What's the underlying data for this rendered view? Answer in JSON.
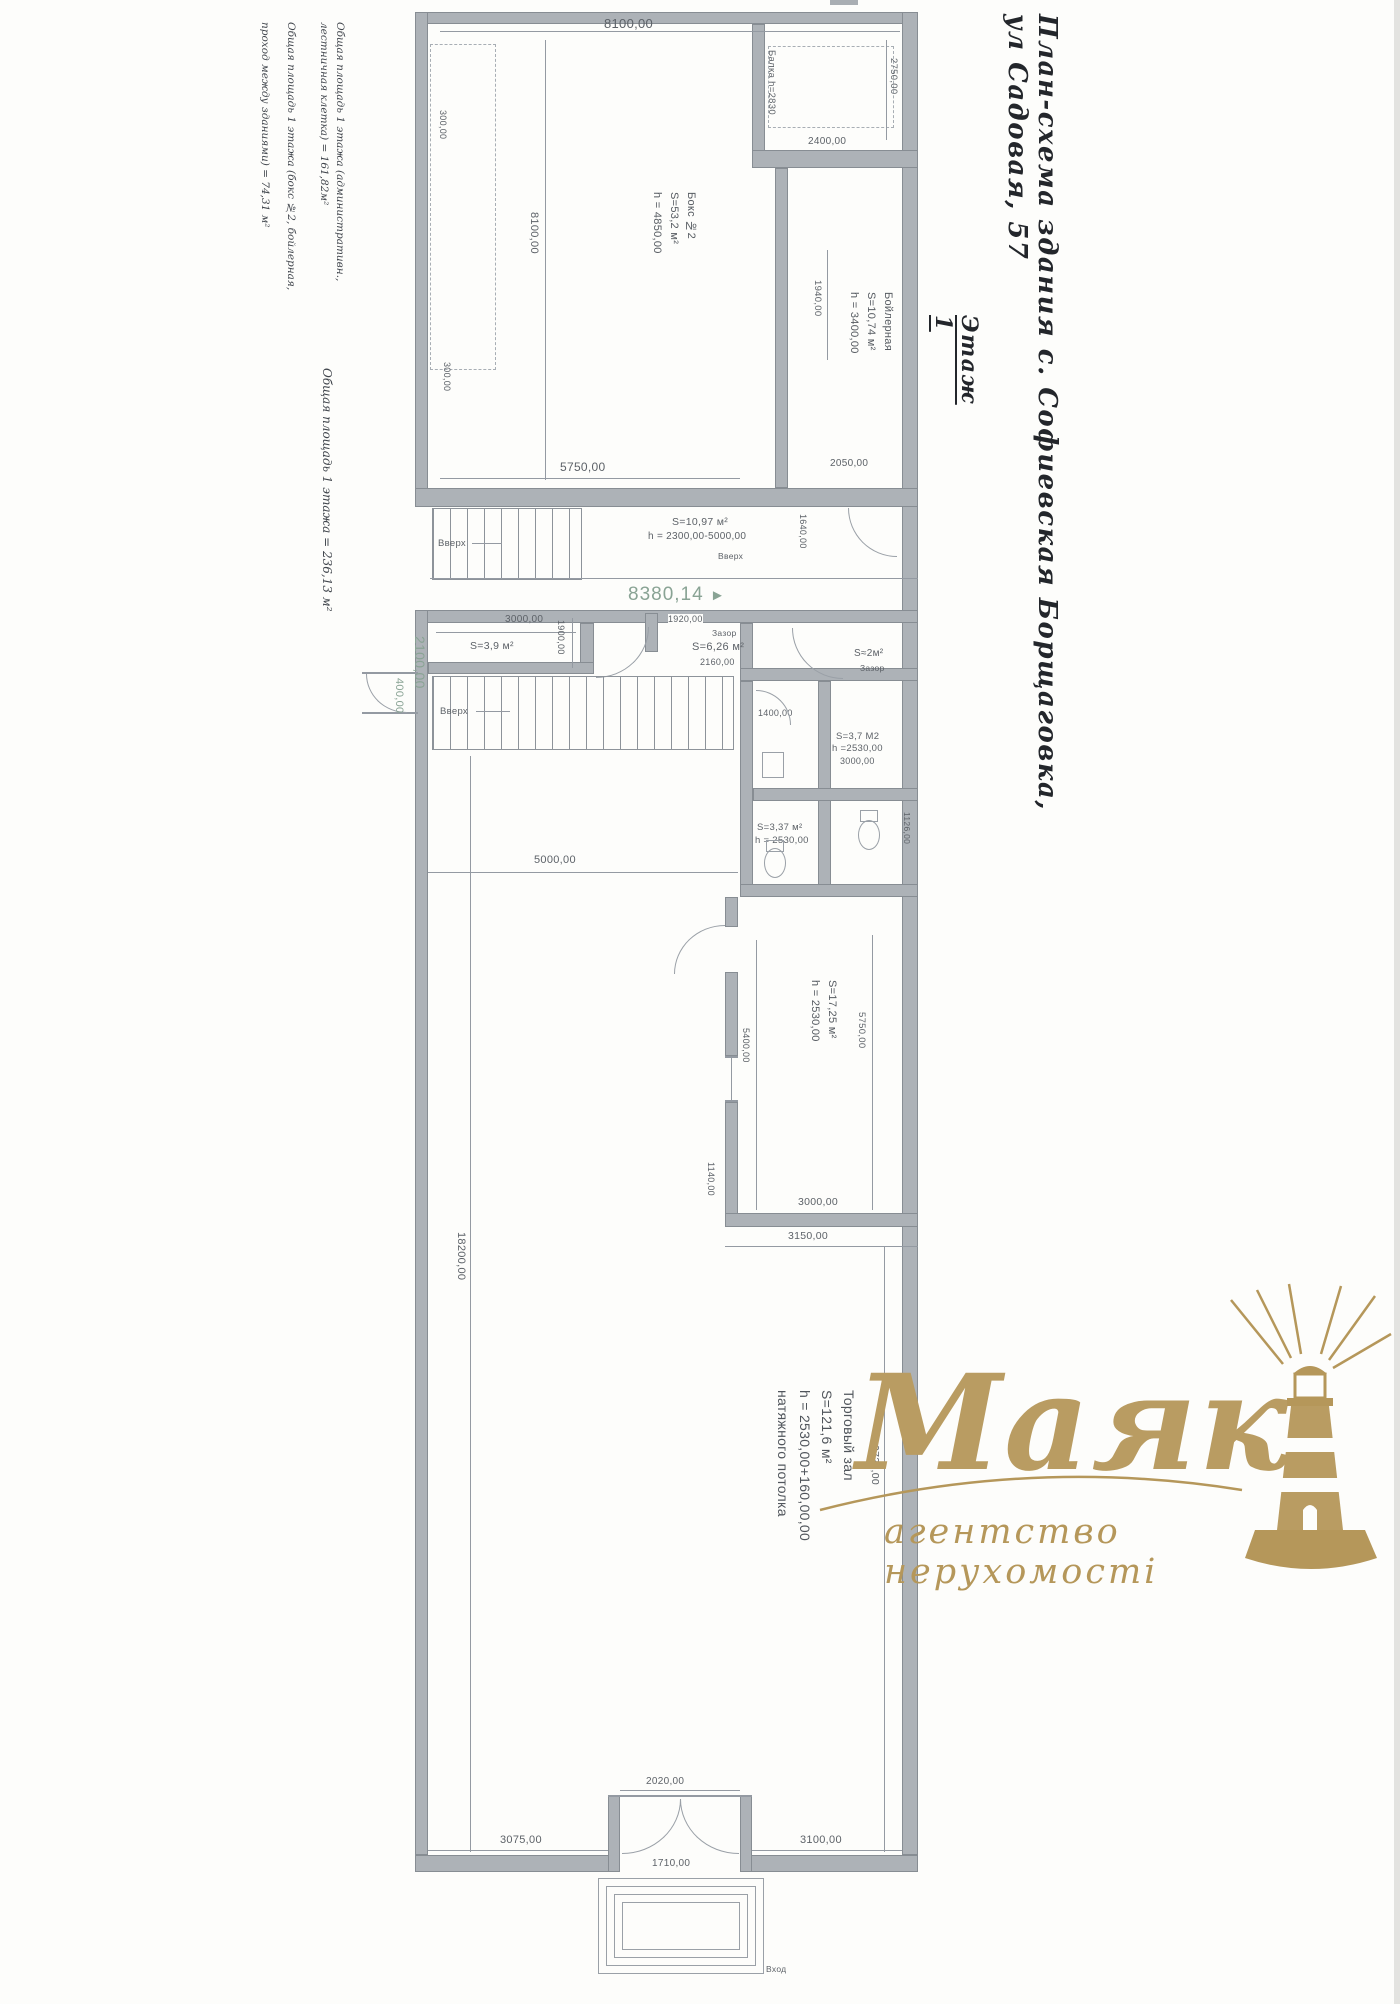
{
  "colors": {
    "ink": "#23262b",
    "line": "#949aa2",
    "dim_text": "#5d6268",
    "teal": "#89a394",
    "gold": "#b5975a"
  },
  "header": {
    "title": "План-схема здания с. Софиевская Борщаговка, ул Садовая, 57",
    "floor": "Этаж 1"
  },
  "notes": {
    "n1a": "Общая площадь 1 этажа (административн.,",
    "n1b": "лестничная клетка) = 161,82м²",
    "n2a": "Общая площадь 1 этажа (бокс №2, бойлерная,",
    "n2b": "проход между зданиями) = 74,31 м²",
    "n3": "Общая площадь 1 этажа = 236,13 м²"
  },
  "rooms": {
    "boks": {
      "name": "Бокс №2",
      "area": "S=53,2 м²",
      "height": "h = 4850,00"
    },
    "boiler": {
      "name": "Бойлерная",
      "area": "S=10,74 м²",
      "height": "h = 3400,00"
    },
    "vest": {
      "area": "S=10,97 м²",
      "height": "h = 2300,00-5000,00"
    },
    "s39": {
      "area": "S=3,9 м²"
    },
    "s626": {
      "area": "S=6,26 м²"
    },
    "s2": {
      "area": "S≈2м²"
    },
    "wc1": {
      "area": "S=3,7 М2",
      "height": "h =2530,00",
      "dim": "3000,00"
    },
    "wc2": {
      "area": "S=3,37 м²",
      "height": "h = 2530,00"
    },
    "s1725": {
      "area": "S=17,25 м²",
      "height": "h = 2530,00"
    },
    "hall": {
      "name": "Торговый зал",
      "area": "S=121,6 м²",
      "height": "h = 2530,00+160,00,00",
      "note": "натяжного потолка"
    }
  },
  "labels": {
    "up": "Вверх",
    "gap": "Зазор",
    "entry": "Вход",
    "balka": "Балка h=2830"
  },
  "dims": {
    "top8100": "8100,00",
    "left8100": "8100,00",
    "v2750": "2750,00",
    "h2400": "2400,00",
    "p300a": "300,00",
    "p300b": "300,00",
    "boks5750": "5750,00",
    "boil2050": "2050,00",
    "boil1940": "1940,00",
    "cor1640": "1640,00",
    "adm3000": "3000,00",
    "adm1900": "1900,00",
    "adm1920": "1920,00",
    "adm2160": "2160,00",
    "wc1400": "1400,00",
    "wc1126": "1126,00",
    "mid5000": "5000,00",
    "hall18200": "18200,00",
    "hall9720": "9720,00",
    "rm5750": "5750,00",
    "rm5400": "5400,00",
    "rm3000": "3000,00",
    "rm3150": "3150,00",
    "rm1140": "1140,00",
    "ent2020": "2020,00",
    "ent1710": "1710,00",
    "bot3075": "3075,00",
    "bot3100": "3100,00"
  },
  "annot": {
    "passage": "8380,14",
    "arrow": "►",
    "t2100": "2100,00",
    "t400": "400,00"
  },
  "logo": {
    "brand": "Маяк",
    "tagline": "агентство нерухомості"
  }
}
